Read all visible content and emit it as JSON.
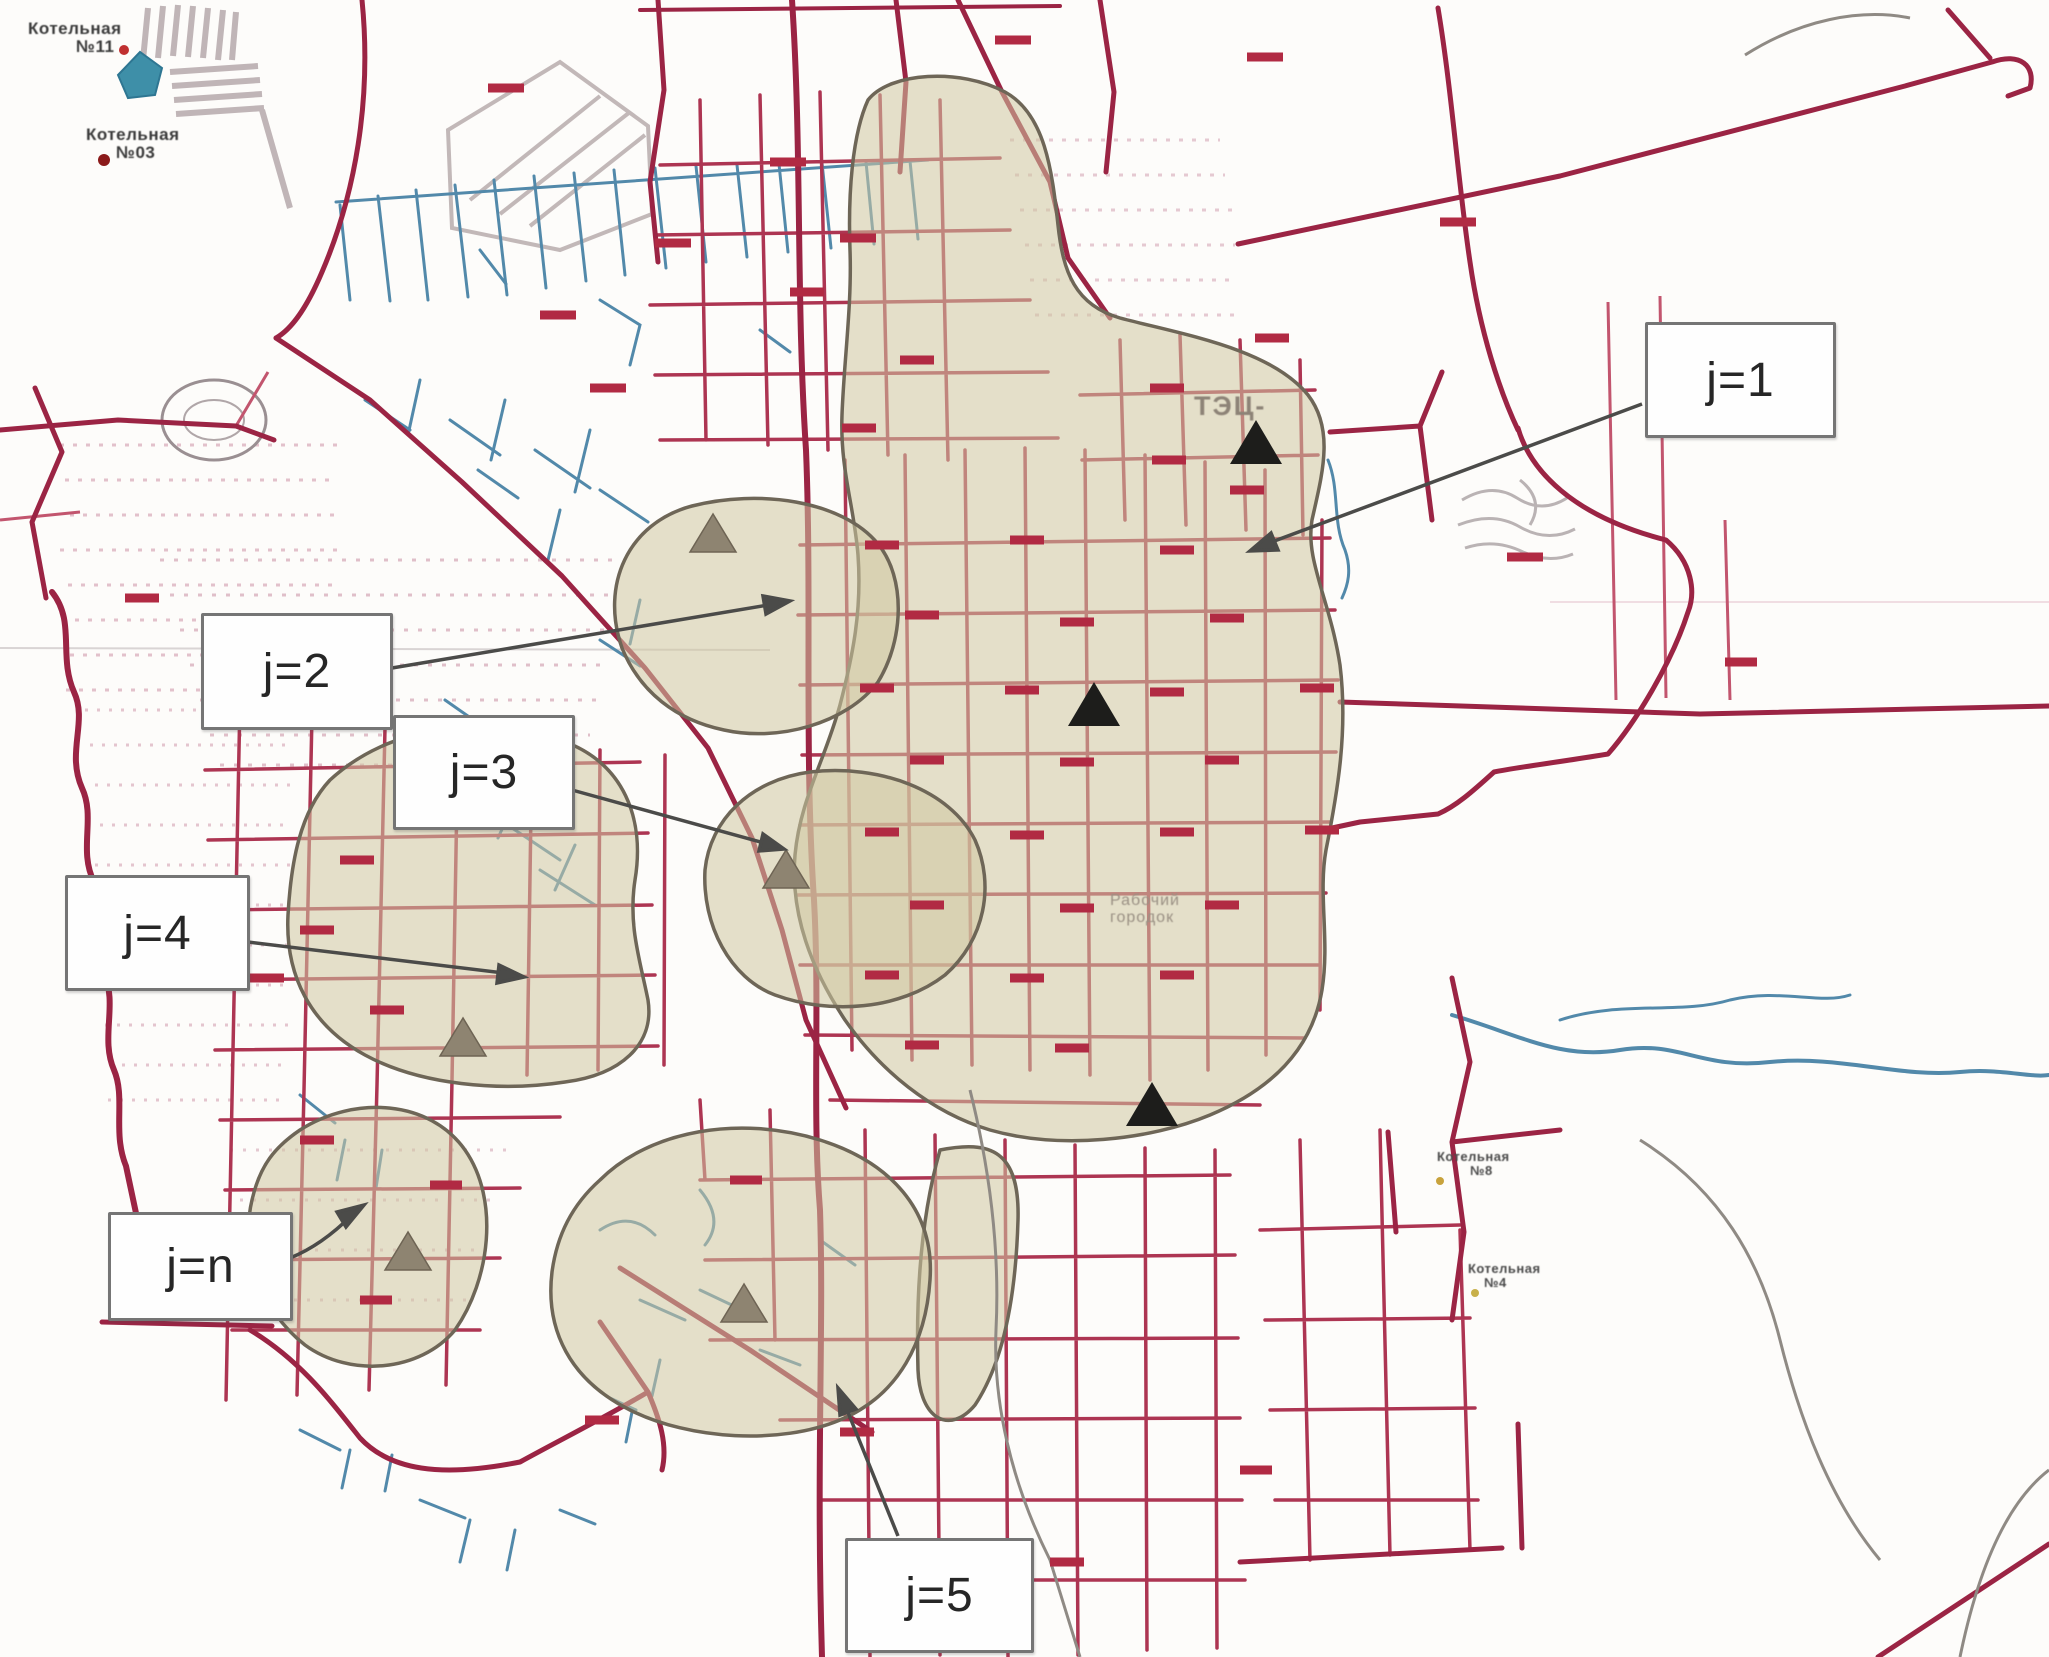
{
  "zone_labels": {
    "j1": "j=1",
    "j2": "j=2",
    "j3": "j=3",
    "j4": "j=4",
    "jn": "j=n",
    "j5": "j=5"
  },
  "map_text": {
    "chp": "ТЭЦ-",
    "boiler_nw1_name": "Котельная",
    "boiler_nw1_num": "№11",
    "boiler_nw2_name": "Котельная",
    "boiler_nw2_num": "№03",
    "boiler_e1_name": "Котельная",
    "boiler_e1_num": "№8",
    "boiler_e2_name": "Котельная",
    "boiler_e2_num": "№4",
    "district_line1": "Рабочий",
    "district_line2": "городок"
  },
  "colors": {
    "road_major": "#9b2444",
    "road_grid": "#ad3552",
    "road_minor": "#c2556e",
    "water": "#5289aa",
    "zone_fill": "#cfc6a0",
    "zone_outline": "#6e6657",
    "triangle_black": "#1d1d1b",
    "triangle_gray": "#8e8471",
    "annotation_arrow": "#4b4b49",
    "dash_marker": "#b12a43",
    "label_border": "#757575",
    "label_text": "#262626",
    "urban_stipple": "#d8aebb",
    "urban_hatch": "#b5a8aa",
    "pond": "#3e8fa8"
  }
}
